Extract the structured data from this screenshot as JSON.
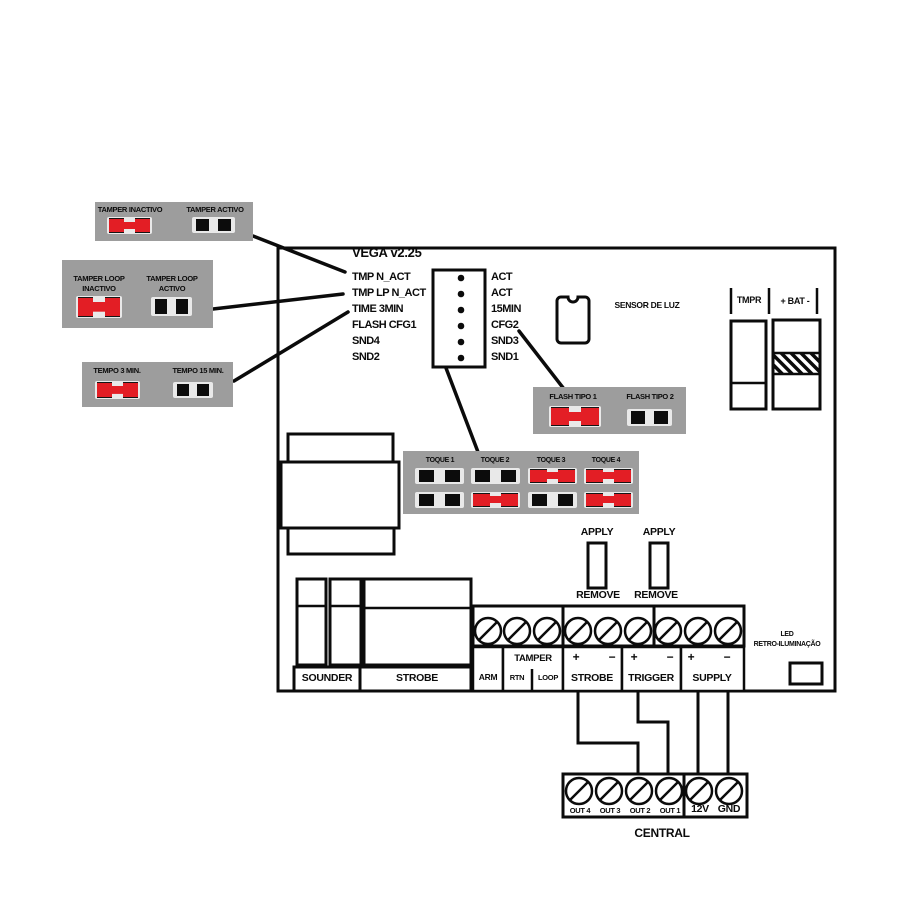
{
  "colors": {
    "red": "#e31e25",
    "panel_gray": "#9d9d9d",
    "cell_gray": "#e9e9e9",
    "line": "#0b0b0b",
    "background": "#ffffff"
  },
  "legend": {
    "tamper": {
      "inactive": "TAMPER INACTIVO",
      "active": "TAMPER ACTIVO",
      "inactive_state": "closed",
      "active_state": "open"
    },
    "tamper_loop": {
      "inactive_line1": "TAMPER LOOP",
      "inactive_line2": "INACTIVO",
      "active_line1": "TAMPER LOOP",
      "active_line2": "ACTIVO",
      "inactive_state": "closed",
      "active_state": "open"
    },
    "tempo": {
      "min3": "TEMPO 3 MIN.",
      "min15": "TEMPO 15 MIN.",
      "min3_state": "closed",
      "min15_state": "open"
    }
  },
  "board": {
    "title": "VEGA v2.25",
    "pin_labels_left": [
      "TMP N_ACT",
      "TMP LP N_ACT",
      "TIME 3MIN",
      "FLASH CFG1",
      "SND4",
      "SND2"
    ],
    "pin_labels_right": [
      "ACT",
      "ACT",
      "15MIN",
      "CFG2",
      "SND3",
      "SND1"
    ],
    "sensor_label": "SENSOR DE LUZ",
    "tmpr_label": "TMPR",
    "battery_label": "+ BAT -",
    "flash": {
      "tipo1": "FLASH TIPO 1",
      "tipo2": "FLASH TIPO 2",
      "tipo1_state": "closed",
      "tipo2_state": "open"
    },
    "toque": {
      "labels": [
        "TOQUE 1",
        "TOQUE 2",
        "TOQUE 3",
        "TOQUE 4"
      ],
      "states": [
        [
          "open",
          "open"
        ],
        [
          "open",
          "closed"
        ],
        [
          "closed",
          "open"
        ],
        [
          "closed",
          "closed"
        ]
      ]
    },
    "apply_label": "APPLY",
    "remove_label": "REMOVE",
    "sounder_label": "SOUNDER",
    "strobe_label": "STROBE",
    "terminals": {
      "arm": "ARM",
      "tamper": "TAMPER",
      "rtn": "RTN",
      "loop": "LOOP",
      "strobe": "STROBE",
      "trigger": "TRIGGER",
      "supply": "SUPPLY",
      "plus": "+",
      "minus": "−"
    },
    "led_line1": "LED",
    "led_line2": "RETRO-ILUMINAÇÃO"
  },
  "central": {
    "label": "CENTRAL",
    "terminals": [
      "OUT 4",
      "OUT 3",
      "OUT 2",
      "OUT 1",
      "12V",
      "GND"
    ]
  }
}
